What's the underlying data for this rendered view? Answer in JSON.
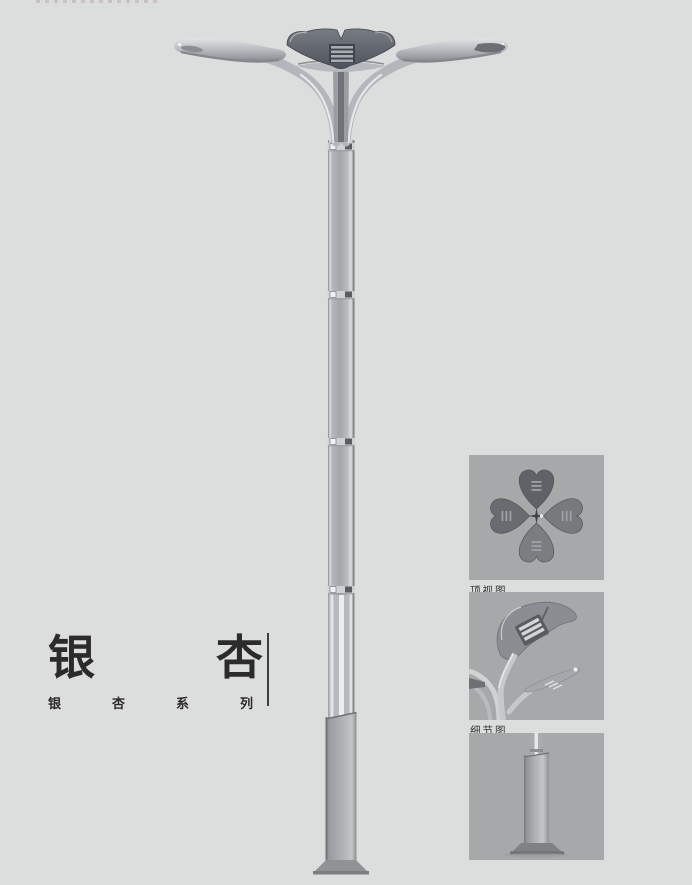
{
  "page": {
    "background_color": "#dcdddd",
    "type": "product-catalog-page"
  },
  "title": {
    "main_chars": [
      "银",
      "杏"
    ],
    "series_chars": [
      "银",
      "杏",
      "系",
      "列"
    ]
  },
  "thumbnails": [
    {
      "name": "top-view-thumbnail",
      "label": "顶视图"
    },
    {
      "name": "detail-view-thumbnail",
      "label": "细节图"
    },
    {
      "name": "base-view-thumbnail",
      "label": ""
    }
  ],
  "illustration": {
    "main": "ginkgo-double-arm-street-lamp-render",
    "views": [
      "top-view",
      "detail-view",
      "base-view"
    ]
  },
  "colors": {
    "page_bg": "#dcdddd",
    "panel_bg": "#a6a8aa",
    "title_ink": "#2b2b2c",
    "label_ink": "#333435",
    "divider_ink": "#3c3d3e",
    "metal_light": "#e2e4e6",
    "metal_mid": "#b5b8bc",
    "metal_dark": "#85888c",
    "leaf_dark": "#565a61"
  }
}
